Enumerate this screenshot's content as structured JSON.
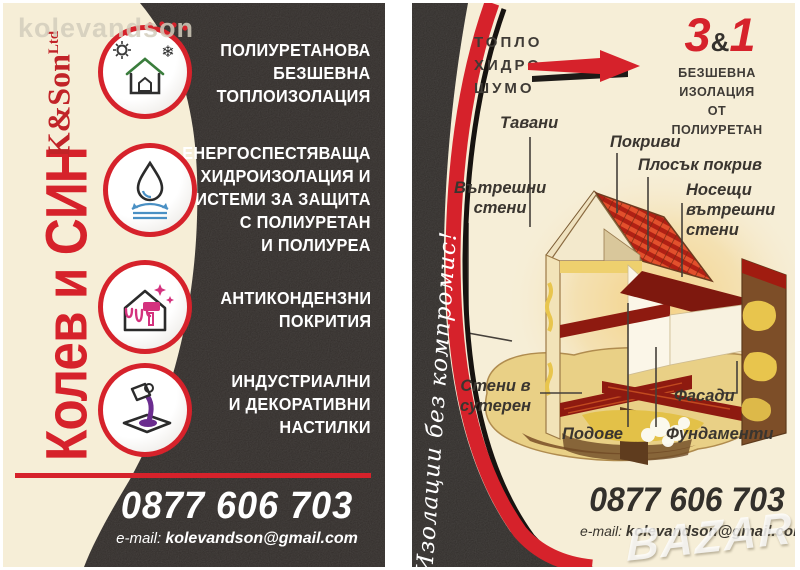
{
  "colors": {
    "accent_red": "#d6222b",
    "cream": "#f6eed7",
    "card_black": "#282320",
    "white_text": "#ffffff",
    "dark_text": "#3a352f"
  },
  "watermark_text": "kolevandson",
  "bazar_watermark": "BAZAR",
  "front": {
    "brand_cyrillic": "Колев и СИН",
    "brand_latin": "K&Son",
    "brand_suffix": "Ltd",
    "services": [
      {
        "icon": "thermal-insulation-house-icon",
        "lines": [
          "ПОЛИУРЕТАНОВА",
          "БЕЗШЕВНА",
          "ТОПЛОИЗОЛАЦИЯ"
        ]
      },
      {
        "icon": "water-drop-icon",
        "lines": [
          "ЕНЕРГОСПЕСТЯВАЩА",
          "ХИДРОИЗОЛАЦИЯ И",
          "СИСТЕМИ ЗА ЗАЩИТА",
          "С ПОЛИУРЕТАН",
          "И ПОЛИУРЕА"
        ]
      },
      {
        "icon": "paint-roller-house-icon",
        "lines": [
          "АНТИКОНДЕНЗНИ",
          "ПОКРИТИЯ"
        ]
      },
      {
        "icon": "pouring-floor-icon",
        "lines": [
          "ИНДУСТРИАЛНИ",
          "И ДЕКОРАТИВНИ",
          "НАСТИЛКИ"
        ]
      }
    ],
    "phone": "0877 606 703",
    "email_label": "e-mail:",
    "email": "kolevandson@gmail.com"
  },
  "back": {
    "badge": {
      "three": "3",
      "amp": "&",
      "one": "1"
    },
    "insulation_types": [
      "ТОПЛО",
      "ХИДРО",
      "ШУМО"
    ],
    "headline_lines": [
      "БЕЗШЕВНА ИЗОЛАЦИЯ",
      "ОТ",
      "ПОЛИУРЕТАН"
    ],
    "slogan": "Изолации без компромис!",
    "diagram_labels": [
      {
        "id": "tavani",
        "lines": [
          "Тавани"
        ]
      },
      {
        "id": "pokrivi",
        "lines": [
          "Покриви"
        ]
      },
      {
        "id": "plosak-pokriv",
        "lines": [
          "Плосък покрив"
        ]
      },
      {
        "id": "vatreshni-steni",
        "lines": [
          "Вътрешни",
          "стени"
        ]
      },
      {
        "id": "noseshti-vatreshni-steni",
        "lines": [
          "Носещи",
          "вътрешни",
          "стени"
        ]
      },
      {
        "id": "steni-v-suteren",
        "lines": [
          "Стени в",
          "сутерен"
        ]
      },
      {
        "id": "fasadi",
        "lines": [
          "Фасади"
        ]
      },
      {
        "id": "podove",
        "lines": [
          "Подове"
        ]
      },
      {
        "id": "fundamenti",
        "lines": [
          "Фундаменти"
        ]
      }
    ],
    "phone": "0877 606 703",
    "email_label": "e-mail:",
    "email": "kolevandson@gmail.com"
  }
}
